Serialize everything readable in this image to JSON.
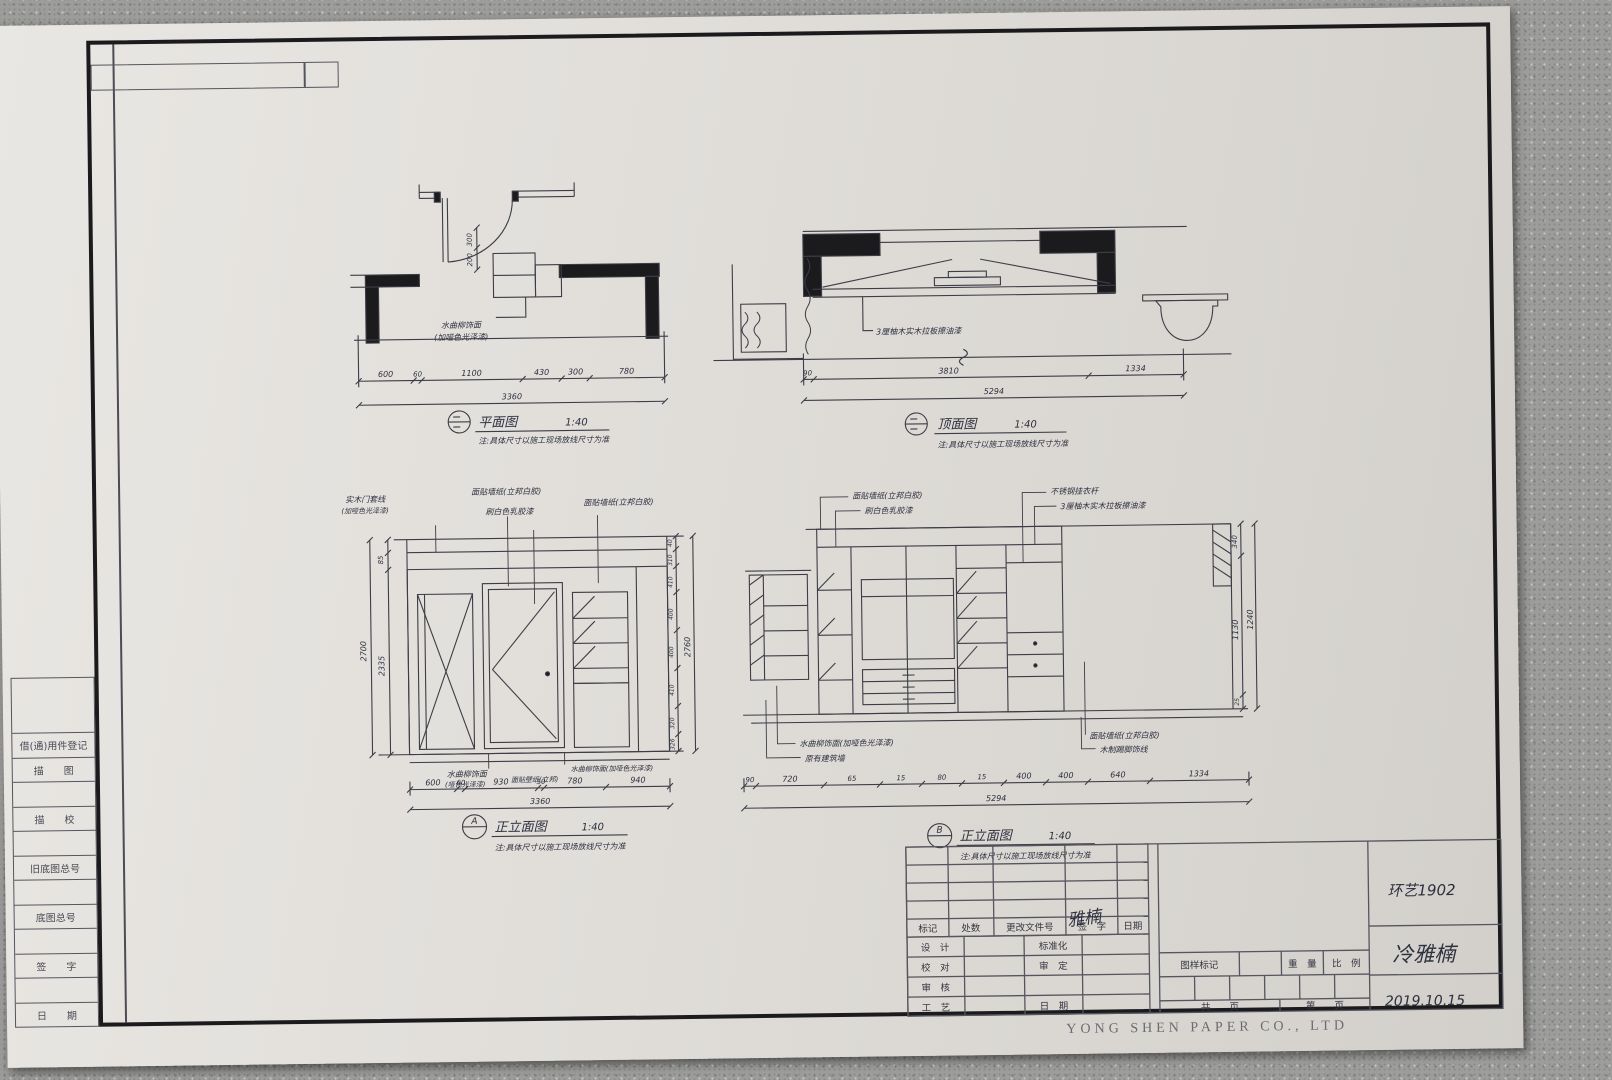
{
  "photo": {
    "paper_company": "YONG SHEN PAPER CO., LTD"
  },
  "sidebar": {
    "rows": [
      "借(通)用件登记",
      "描　　图",
      "",
      "描　　校",
      "",
      "旧底图总号",
      "",
      "底图总号",
      "",
      "签　　字",
      "",
      "日　　期"
    ]
  },
  "titleblock": {
    "rev_headers": [
      "标记",
      "处数",
      "更改文件号",
      "签　字",
      "日期"
    ],
    "left_rows": [
      {
        "a": "设　计",
        "b": "标准化"
      },
      {
        "a": "校　对",
        "b": "审　定"
      },
      {
        "a": "审　核",
        "b": ""
      },
      {
        "a": "工　艺",
        "b": "日　期"
      }
    ],
    "mark_label": "图样标记",
    "weight_label": "重　量",
    "scale_label": "比　例",
    "pages_left": "共　　页",
    "pages_right": "第　　页",
    "signature": "雅楠",
    "class_name": "环艺1902",
    "author": "冷雅楠",
    "date": "2019.10.15"
  },
  "plan": {
    "title": "平面图",
    "scale": "1:40",
    "note": "注:具体尺寸以施工现场放线尺寸为准",
    "ann1": "水曲柳饰面",
    "ann2": "(加哑色光泽漆)",
    "dims": [
      "600",
      "60",
      "1100",
      "430",
      "300",
      "780"
    ],
    "total": "3360",
    "side_dims": [
      "300",
      "200"
    ]
  },
  "ceiling": {
    "title": "顶面图",
    "scale": "1:40",
    "note": "注:具体尺寸以施工现场放线尺寸为准",
    "ann1": "3厘柚木实木拉板擦油漆",
    "dims": [
      "90",
      "3810",
      "1334"
    ],
    "total": "5294"
  },
  "elevA": {
    "ref": "A",
    "title": "正立面图",
    "scale": "1:40",
    "note": "注:具体尺寸以施工现场放线尺寸为准",
    "top_ann": [
      "实木门套线",
      "(加哑色光泽漆)",
      "面贴墙纸(立邦白胶)",
      "刷白色乳胶漆",
      "面贴墙纸(立邦白胶)"
    ],
    "bot_ann": [
      "水曲柳饰面",
      "(哑色光泽漆)",
      "面贴壁纸(立邦)",
      "水曲柳饰面(加哑色光泽漆)"
    ],
    "dims": [
      "600",
      "60",
      "930",
      "50",
      "780",
      "940"
    ],
    "total": "3360",
    "left_dims": [
      "85",
      "2335"
    ],
    "left_total": "2700",
    "right_dims": [
      "40",
      "310",
      "410",
      "400",
      "400",
      "410",
      "320",
      "326"
    ],
    "right_total": "2760"
  },
  "elevB": {
    "ref": "B",
    "title": "正立面图",
    "scale": "1:40",
    "note": "注:具体尺寸以施工现场放线尺寸为准",
    "top_ann": [
      "面贴墙纸(立邦白胶)",
      "刷白色乳胶漆",
      "不锈钢挂衣杆",
      "3厘柚木实木拉板擦油漆"
    ],
    "bot_ann": [
      "水曲柳饰面(加哑色光泽漆)",
      "原有建筑墙",
      "面贴墙纸(立邦白胶)",
      "木制踢脚饰线"
    ],
    "dims": [
      "90",
      "720",
      "65",
      "15",
      "80",
      "15",
      "400",
      "400",
      "640",
      "1334"
    ],
    "total": "5294",
    "right_dims": [
      "340",
      "1130",
      "25"
    ],
    "right_total": "1240"
  }
}
